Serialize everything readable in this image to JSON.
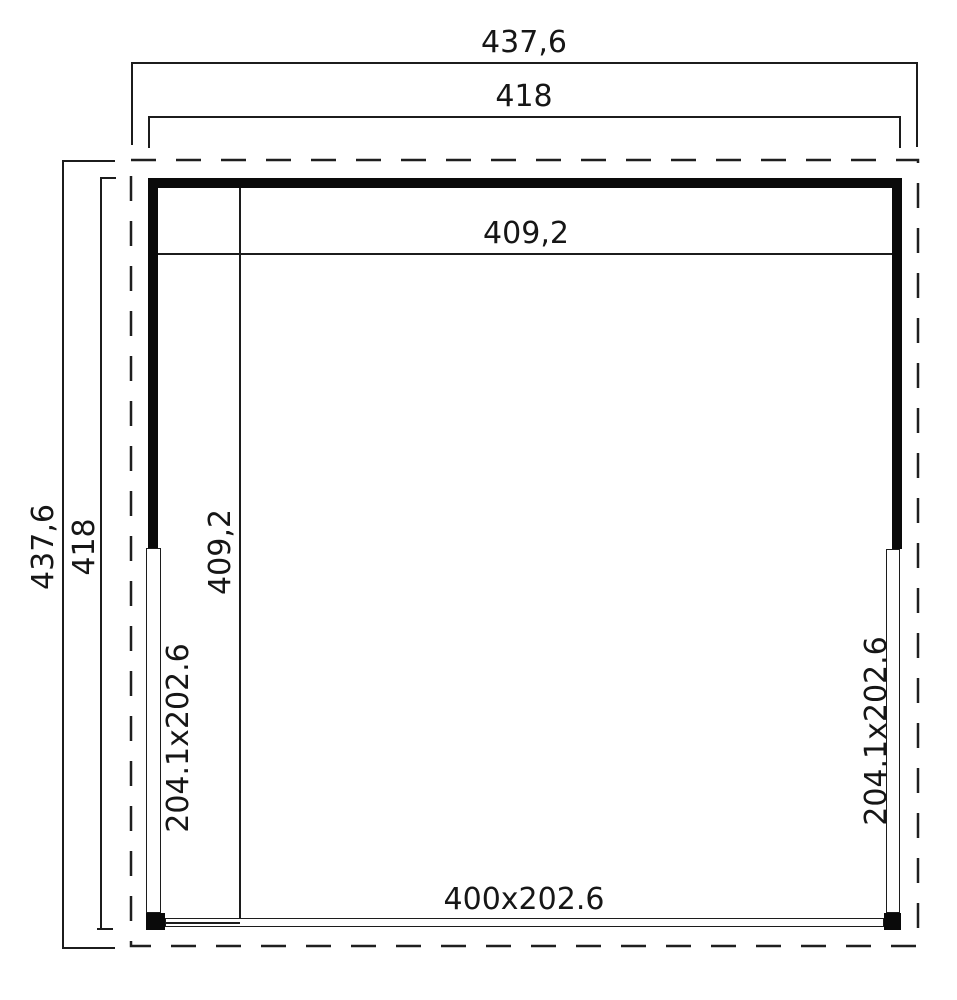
{
  "plan": {
    "top_dimensions": {
      "outer": "437,6",
      "wall": "418",
      "inner": "409,2"
    },
    "left_dimensions": {
      "outer": "437,6",
      "wall": "418",
      "inner": "409,2"
    },
    "openings": {
      "left": "204.1x202.6",
      "right": "204.1x202.6",
      "front": "400x202.6"
    },
    "colors": {
      "line": "#1c1c1c",
      "wall": "#0a0a0a",
      "background": "#ffffff"
    }
  }
}
